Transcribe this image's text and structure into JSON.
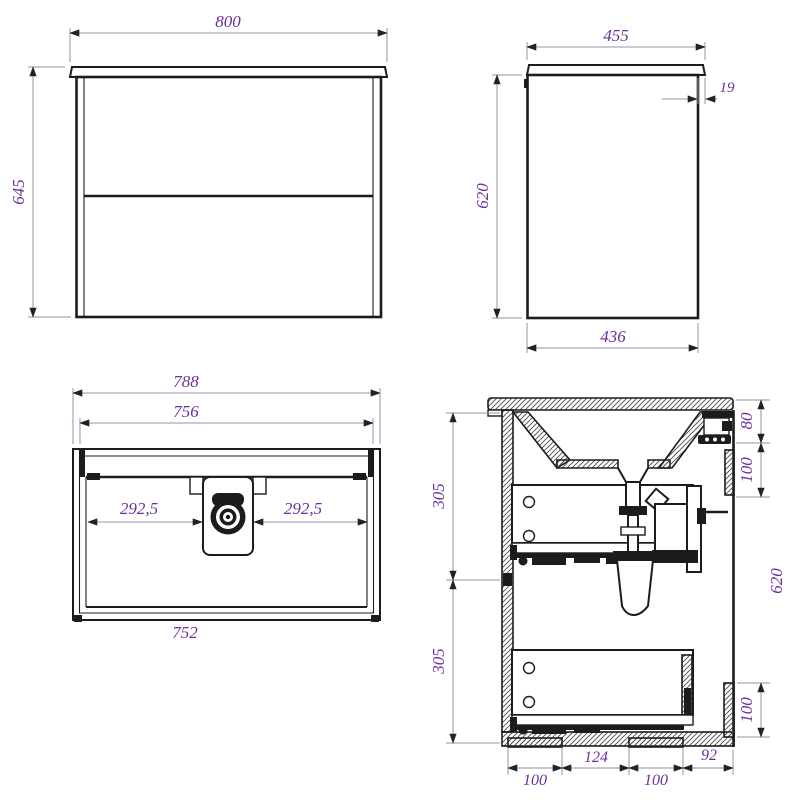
{
  "palette": {
    "background": "#ffffff",
    "object_line": "#1c1c1c",
    "dimension_line": "#9a8fae",
    "dimension_text": "#6b2f9e"
  },
  "views": {
    "front": {
      "width": "800",
      "height": "645"
    },
    "side": {
      "top_width": "455",
      "overhang": "19",
      "height": "620",
      "bottom_width": "436"
    },
    "plan": {
      "outer_width": "788",
      "inner_width": "756",
      "center_left": "292,5",
      "center_right": "292,5",
      "bottom_width": "752"
    },
    "section": {
      "upper_drawer_height": "305",
      "lower_drawer_height": "305",
      "top_offset": "80",
      "upper_bracket": "100",
      "overall_height": "620",
      "lower_bracket": "100",
      "bottom_offsets": [
        "100",
        "124",
        "100",
        "92"
      ]
    }
  }
}
